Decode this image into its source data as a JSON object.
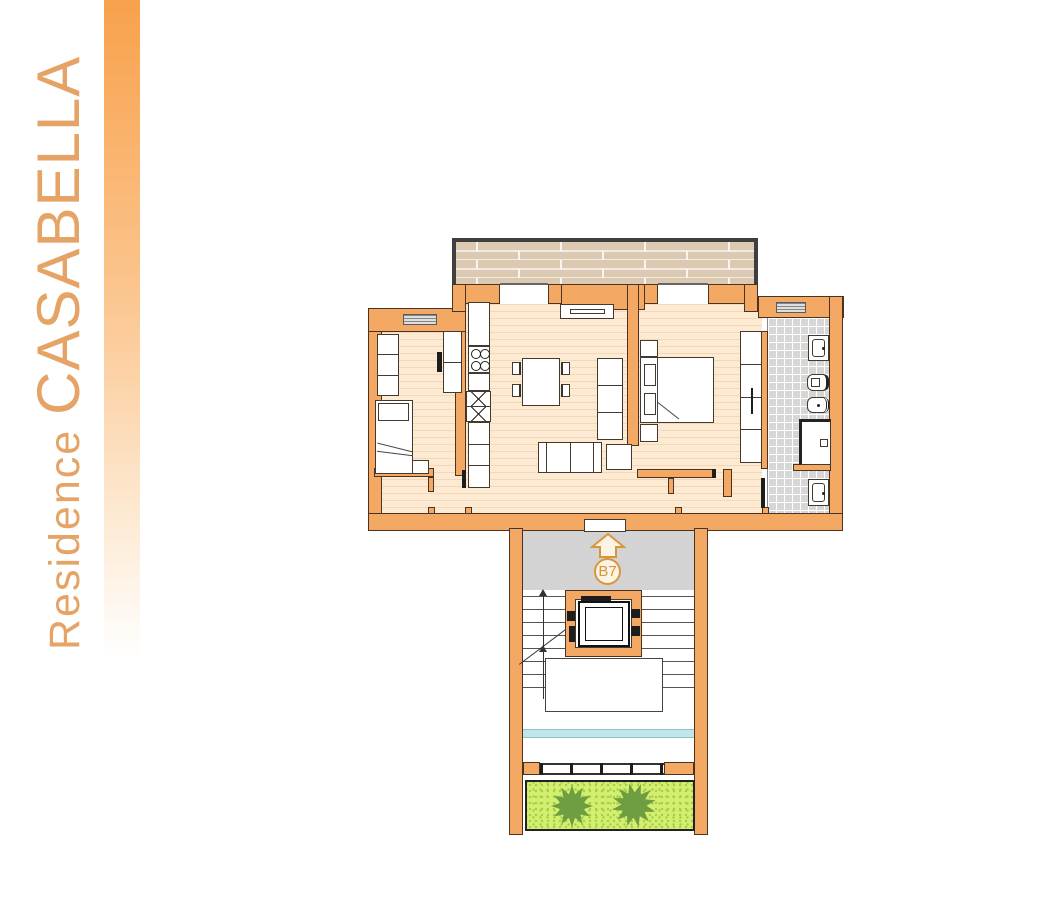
{
  "branding": {
    "residence_label": "Residence ",
    "name": "CASABELLA"
  },
  "unit": {
    "label": "B7",
    "direction_icon": "up-arrow-icon"
  },
  "colors": {
    "sidebar_bar_top": "#f8a14c",
    "brand_text": "#e5a365",
    "wall_fill": "#f3a964",
    "wall_outline": "#4a3421",
    "floor_fill": "#fdead3",
    "floor_stripe": "#f4d7b8",
    "deck_fill": "#dcc9b1",
    "deck_frame": "#3f3f3f",
    "tile_fill": "#d6d6d6",
    "landing_fill": "#d3d3d3",
    "badge_outline": "#d8953c",
    "badge_fill": "#fbf4e4",
    "water_strip": "#bfe6e8",
    "garden_fill": "#d3ef70",
    "garden_speckle": "#a6cc45",
    "tree_fill": "#6f9e42"
  }
}
